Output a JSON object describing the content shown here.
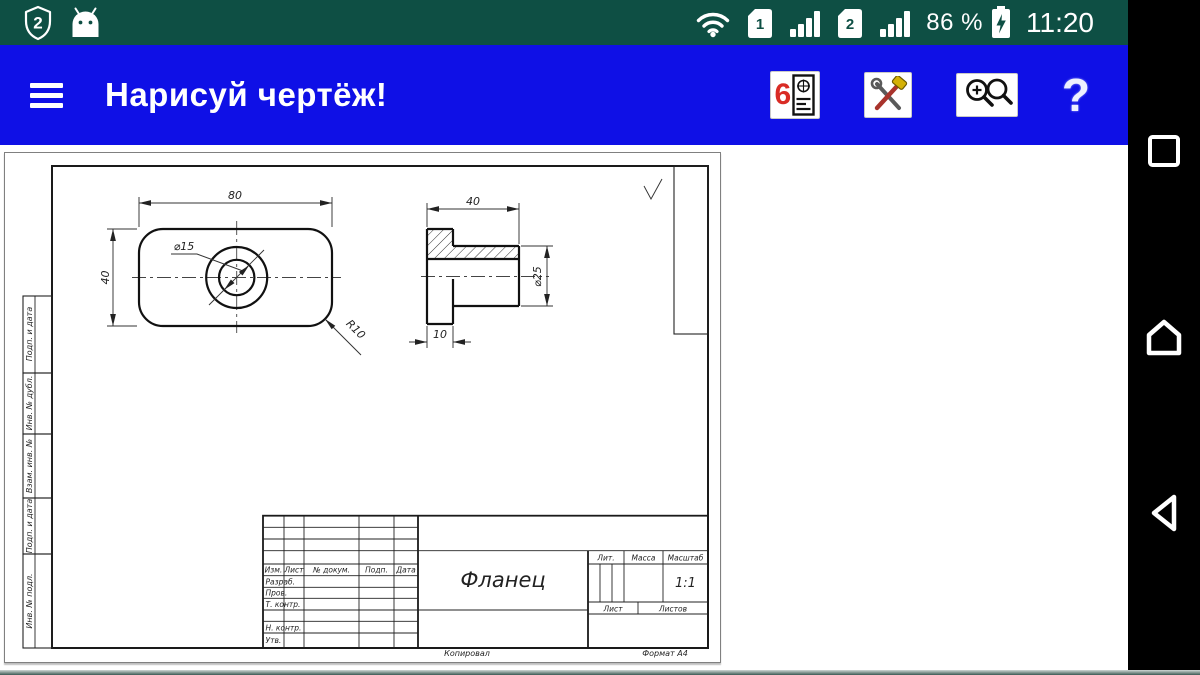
{
  "colors": {
    "status_bar_bg": "#0e4f44",
    "app_bar_bg": "#0f10e6",
    "nav_bar_bg": "#000000",
    "task_number_red": "#d92b25"
  },
  "status_bar": {
    "shield_badge": "2",
    "sim1_label": "1",
    "sim2_label": "2",
    "battery_percent": "86 %",
    "time": "11:20"
  },
  "app_bar": {
    "title": "Нарисуй чертёж!",
    "task_icon_number": "6",
    "help_label": "?"
  },
  "drawing": {
    "top_view": {
      "width": "80",
      "height": "40",
      "hole_diameter": "⌀15",
      "corner_radius": "R10"
    },
    "side_view": {
      "length": "40",
      "boss_diameter": "⌀25",
      "plate_thickness": "10"
    },
    "margin_columns": [
      "Подп. и дата",
      "Инв. № дубл.",
      "Взам. инв. №",
      "Подп. и дата",
      "Инв. № подл."
    ],
    "title_block": {
      "part_name": "Фланец",
      "scale_value": "1:1",
      "col_izm": "Изм.",
      "col_list": "Лист",
      "col_doc": "№ докум.",
      "col_podp": "Подп.",
      "col_data": "Дата",
      "col_lit": "Лит.",
      "col_massa": "Масса",
      "col_masshtab": "Масштаб",
      "col_sheet": "Лист",
      "col_sheets": "Листов",
      "row_razrab": "Разраб.",
      "row_prov": "Пров.",
      "row_tkontr": "Т. контр.",
      "row_nkontr": "Н. контр.",
      "row_utv": "Утв.",
      "footer_copied": "Копировал",
      "footer_format": "Формат А4"
    }
  }
}
